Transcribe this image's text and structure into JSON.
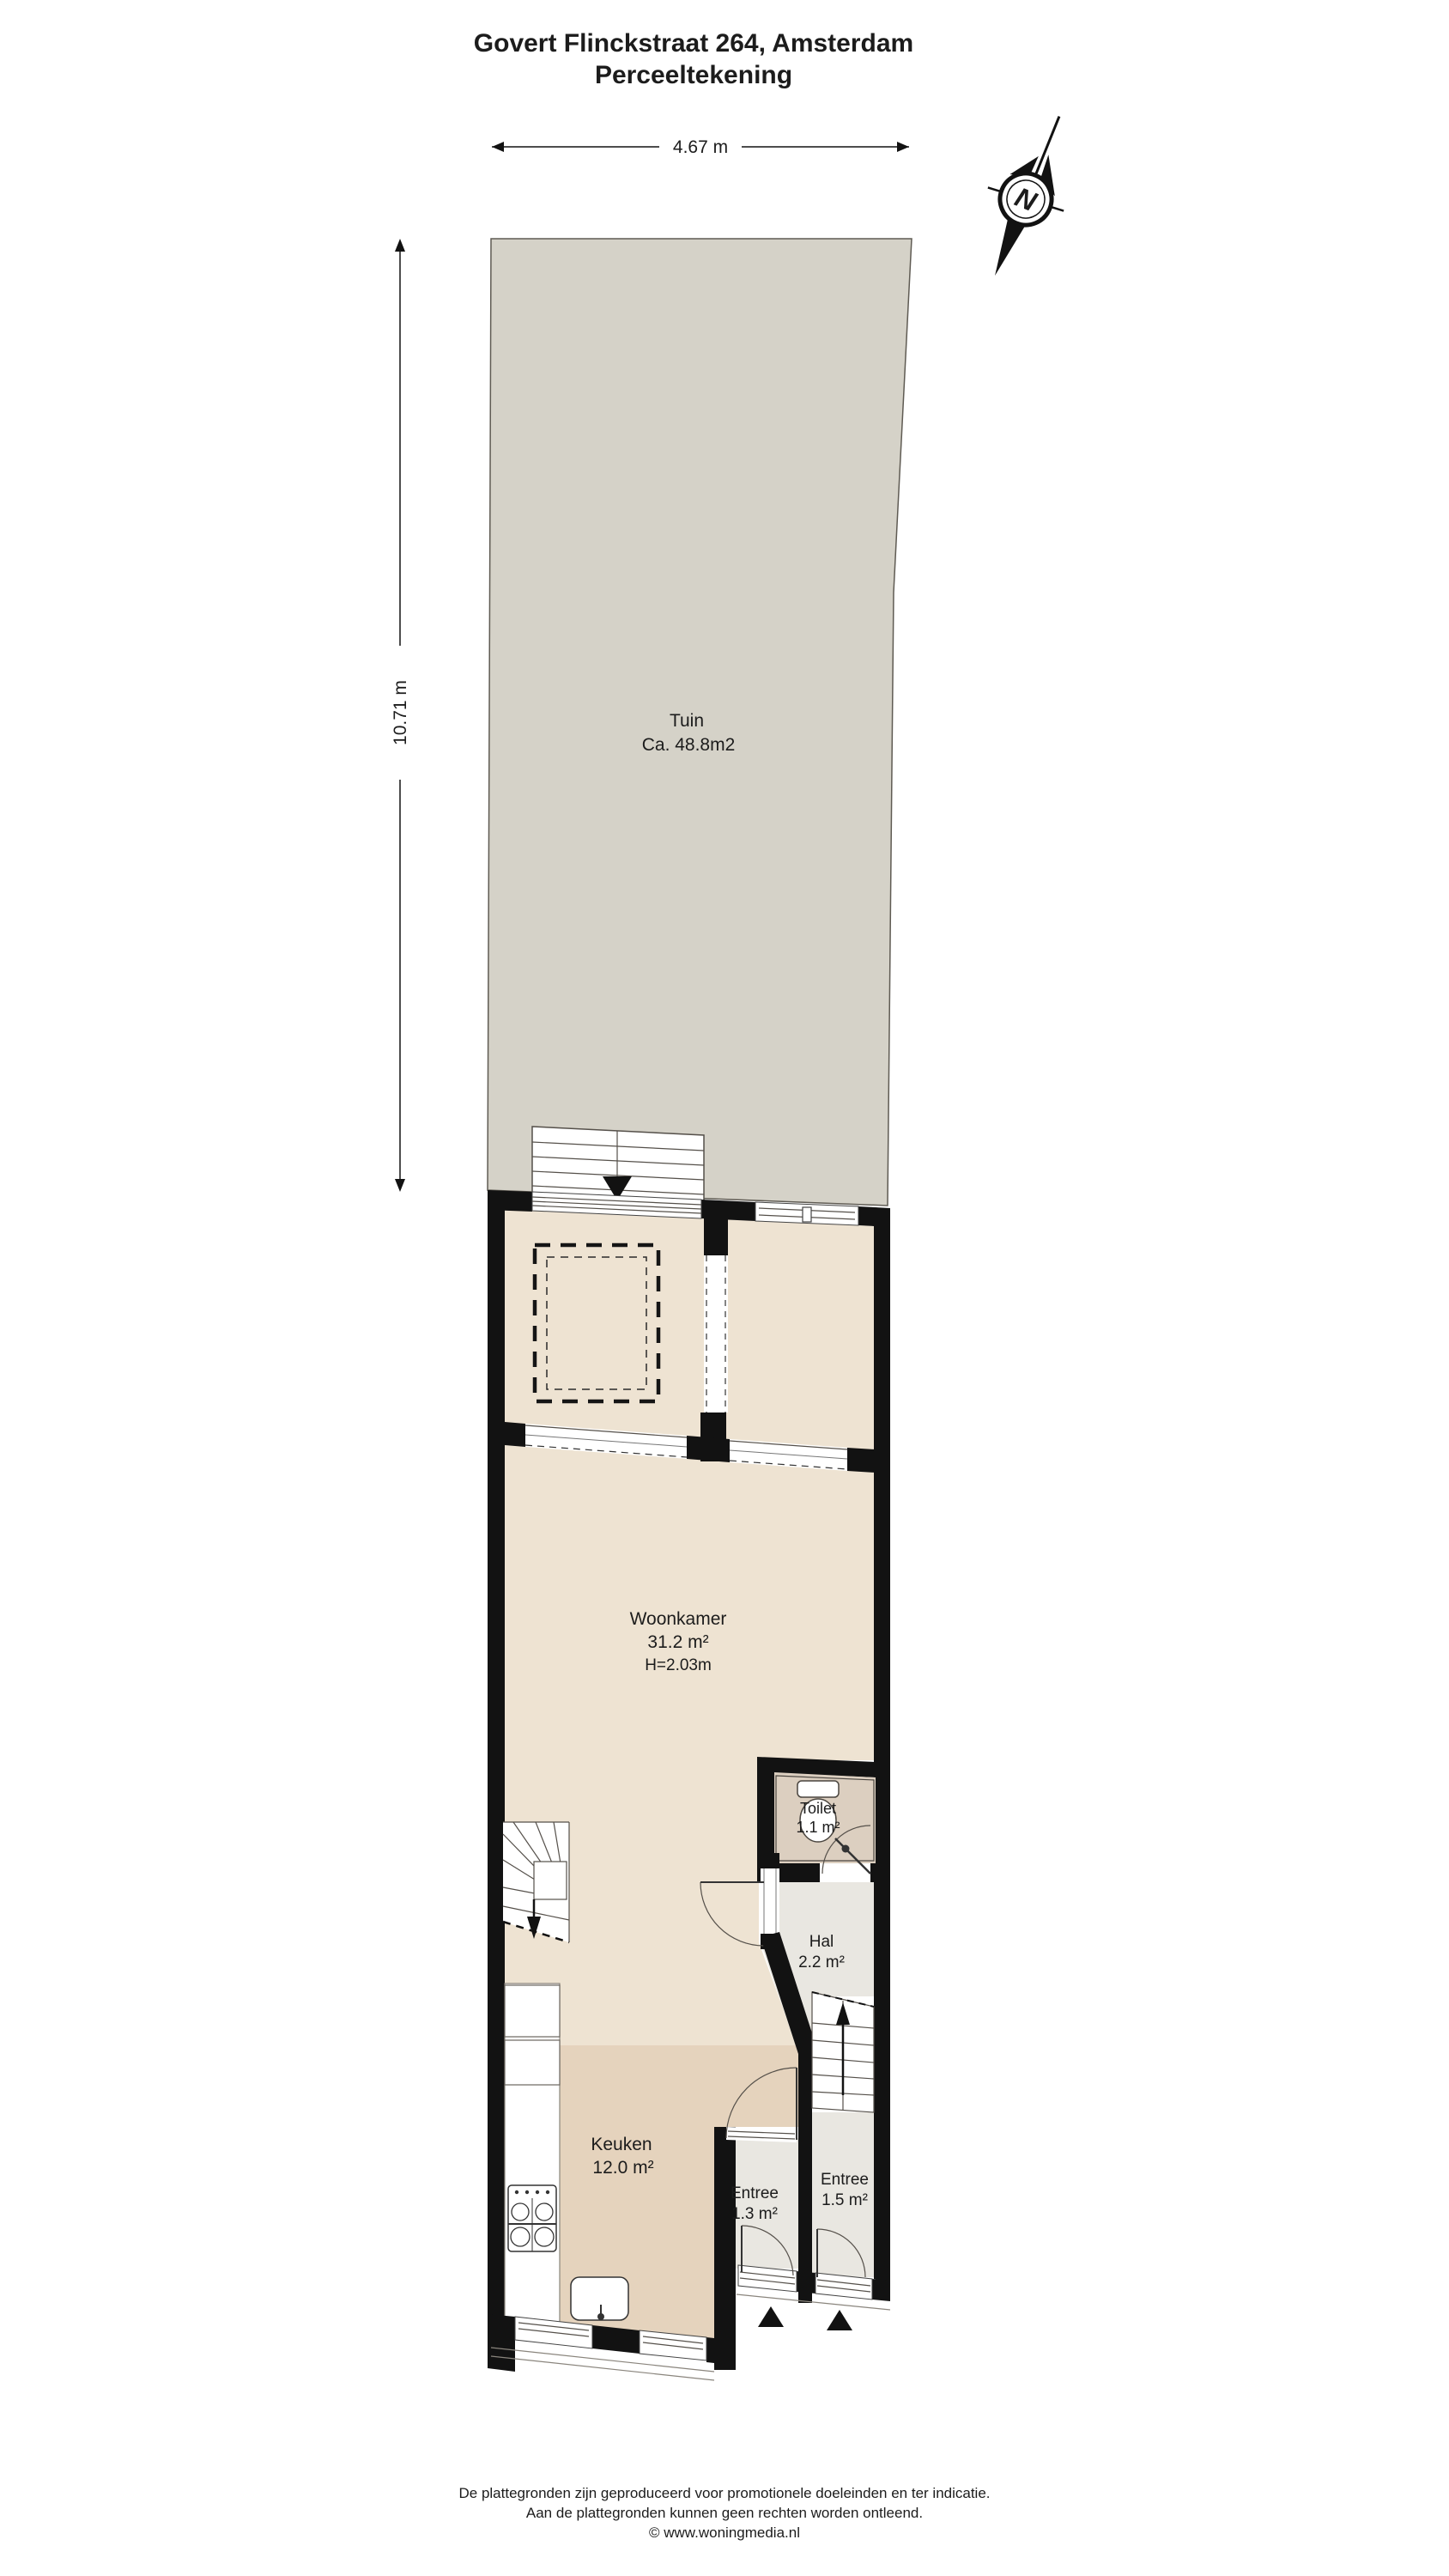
{
  "title": {
    "line1": "Govert Flinckstraat 264, Amsterdam",
    "line2": "Perceeltekening"
  },
  "dimensions": {
    "plot_width": "4.67 m",
    "plot_depth": "10.71 m"
  },
  "compass": {
    "north_label": "N"
  },
  "rooms": {
    "tuin": {
      "name": "Tuin",
      "area": "Ca. 48.8m2"
    },
    "woonkamer": {
      "name": "Woonkamer",
      "area": "31.2 m²",
      "ceiling_height": "H=2.03m"
    },
    "toilet": {
      "name": "Toilet",
      "area": "1.1 m²"
    },
    "hal": {
      "name": "Hal",
      "area": "2.2 m²"
    },
    "keuken": {
      "name": "Keuken",
      "area": "12.0 m²"
    },
    "entree_left": {
      "name": "Entree",
      "area": "1.3 m²"
    },
    "entree_right": {
      "name": "Entree",
      "area": "1.5 m²"
    }
  },
  "footer": {
    "line1": "De plattegronden zijn geproduceerd voor promotionele doeleinden en ter indicatie.",
    "line2": "Aan de plattegronden kunnen geen rechten worden ontleend.",
    "line3": "© www.woningmedia.nl"
  },
  "colors": {
    "wall": "#121212",
    "garden": "#d5d2c8",
    "floor": "#eee3d2",
    "kitchen_floor": "#e5d3bd",
    "toilet_floor": "#dccfc0",
    "hall_floor": "#e9e7e1",
    "fixture_line": "#55504a",
    "text": "#1c1c1c"
  }
}
